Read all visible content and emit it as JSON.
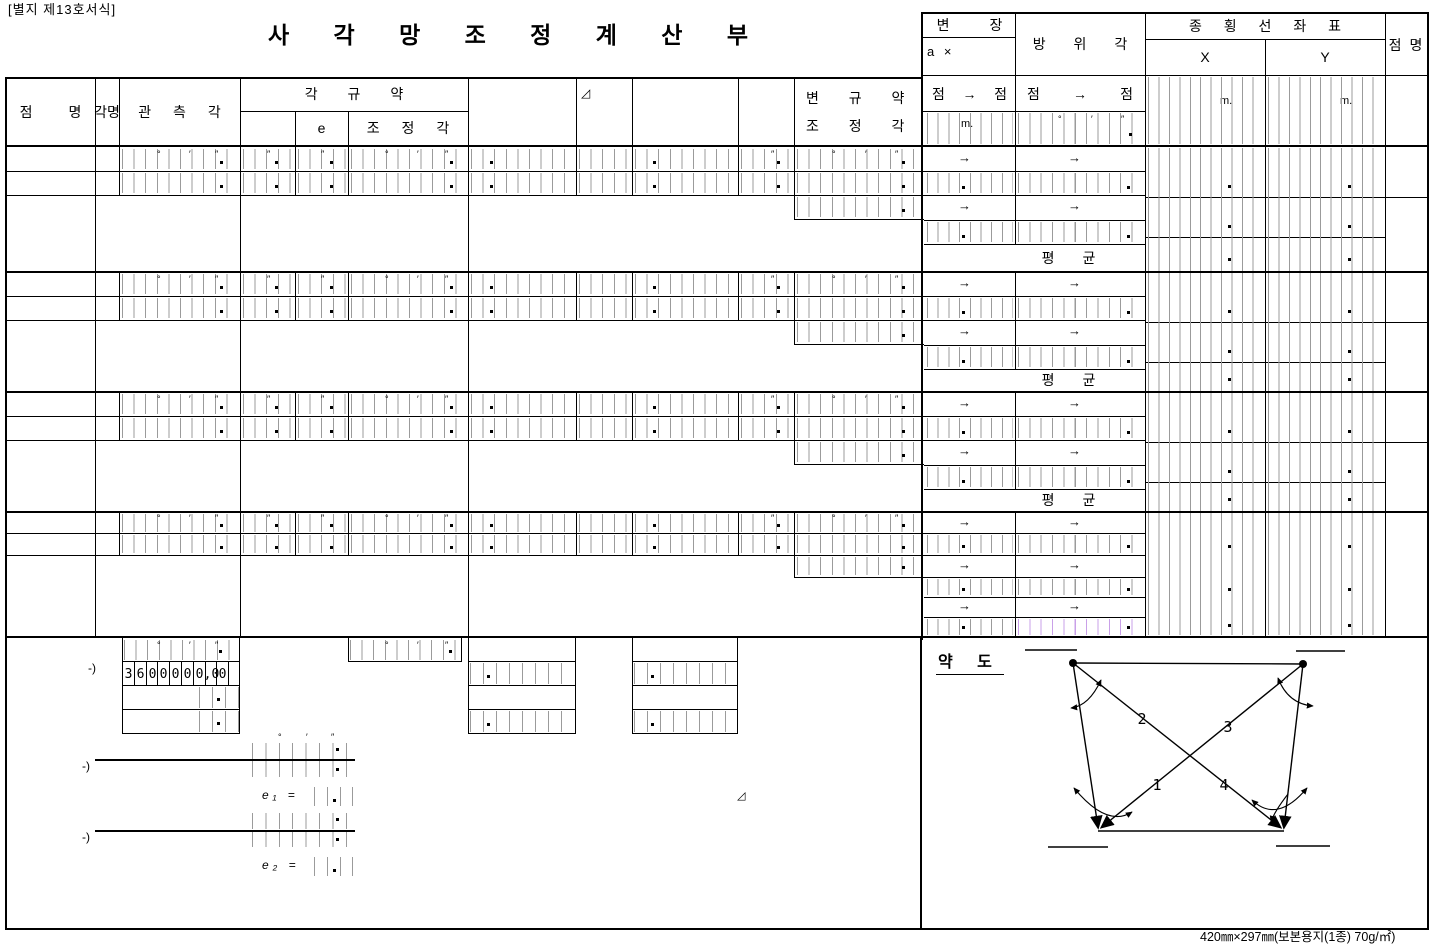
{
  "page": {
    "form_label": "[별지 제13호서식]",
    "title": "사 각 망 조 정 계 산 부",
    "footer": "420㎜×297㎜(보본용지(1종) 70g/㎡)"
  },
  "sym": {
    "deg": "°",
    "min": "′",
    "sec": "″",
    "dot": ".",
    "arrow": "→",
    "delta": "◿",
    "m": "m."
  },
  "header": {
    "point_name": "점 명",
    "angle_name": "각명",
    "observed_angle": "관 측 각",
    "angle_rule": "각 규 약",
    "e": "e",
    "adjusted_angle": "조 정 각",
    "side_rule_l1": "변 규 약",
    "side_rule_l2": "조 정 각",
    "side_length": "변 장",
    "a_x": "a ×",
    "azimuth": "방 위 각",
    "coord_table": "종 횡 선 좌 표",
    "x": "X",
    "y": "Y",
    "point_name_right": "점 명",
    "pt": "점"
  },
  "body": {
    "mean": "평 균"
  },
  "bottom": {
    "minus": "-)",
    "sum_digits": [
      "3",
      "6",
      "0",
      "0",
      "0",
      "0",
      "0",
      ",0",
      "0"
    ],
    "e1": "e₁ =",
    "e2": "e₂ =",
    "sketch_title": "약 도",
    "diagram_labels": [
      "1",
      "2",
      "3",
      "4"
    ]
  },
  "colors": {
    "line": "#000000",
    "tick": "#9b9b9b",
    "tick_accent": "#c9a0e8",
    "paper": "#ffffff"
  }
}
